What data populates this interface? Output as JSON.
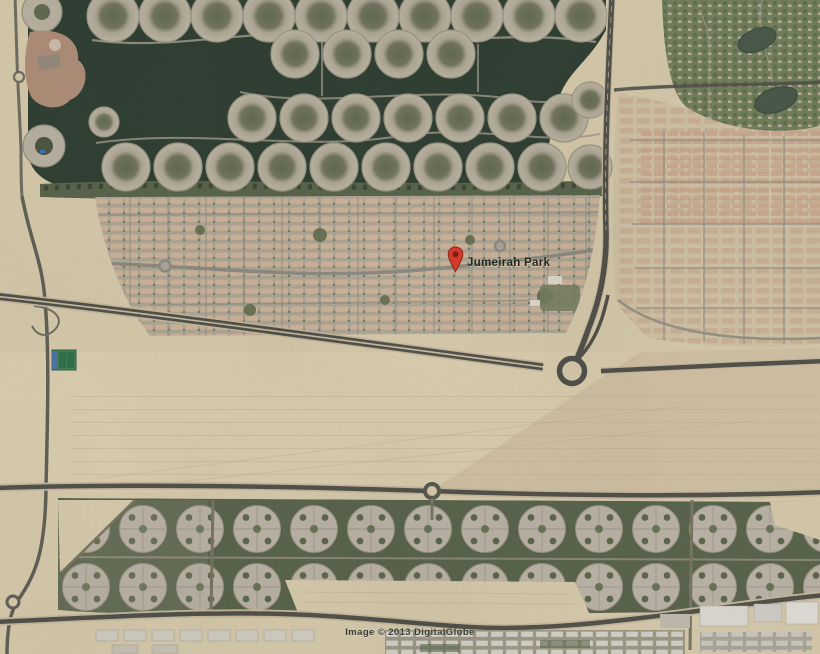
{
  "map": {
    "marker": {
      "label": "Jumeirah Park"
    },
    "attribution": "Image © 2013 DigitalGlobe"
  },
  "colors": {
    "sand": "#d2c5a6",
    "sand-dark": "#c5b597",
    "water": "#2e3d31",
    "villa-base": "#a8a190",
    "street": "#8f8c80",
    "road": "#4e4e47",
    "green-dark": "#566049",
    "estate-green": "#6d7958",
    "lake": "#465547",
    "cluster": "#b6aea0",
    "marker-red": "#d63a2b",
    "label-text": "#23271c",
    "attribution-text": "#3a3b34"
  }
}
